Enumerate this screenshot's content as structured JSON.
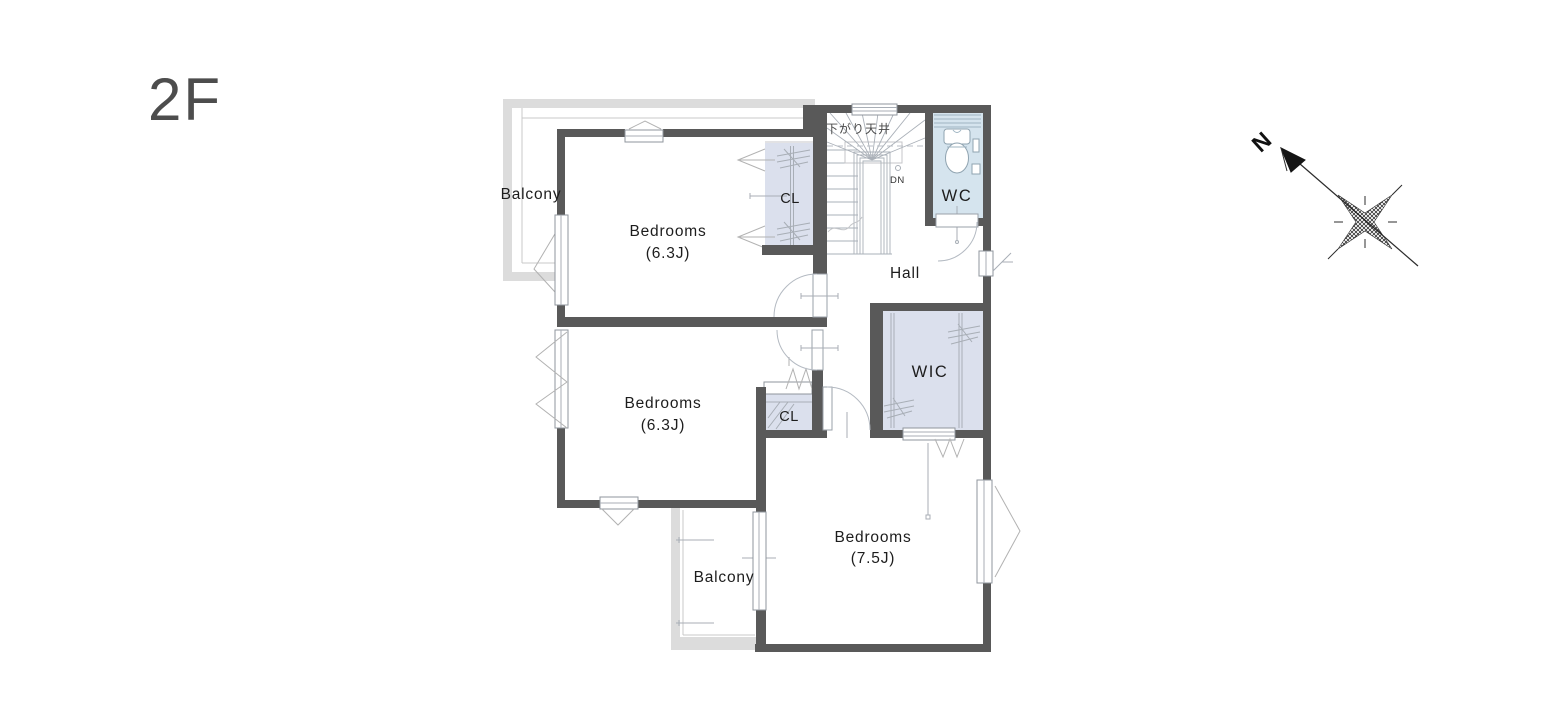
{
  "title": "2F",
  "rooms": {
    "bedroom1": {
      "label": "Bedrooms",
      "size": "(6.3J)"
    },
    "bedroom2": {
      "label": "Bedrooms",
      "size": "(6.3J)"
    },
    "bedroom3": {
      "label": "Bedrooms",
      "size": "(7.5J)"
    },
    "hall": {
      "label": "Hall"
    },
    "wc": {
      "label": "WC"
    },
    "wic": {
      "label": "WIC"
    },
    "closet_top": {
      "label": "CL"
    },
    "closet_bottom": {
      "label": "CL"
    },
    "balcony_top": {
      "label": "Balcony"
    },
    "balcony_bottom": {
      "label": "Balcony"
    }
  },
  "stairs": {
    "ceiling_note": "下がり天井",
    "direction_label": "DN"
  },
  "compass": {
    "north_label": "N"
  },
  "colors": {
    "wall": "#595959",
    "closet_fill": "#dbe0ed",
    "wc_fill": "#d5e4ee",
    "balcony_wall": "#dcdcdc",
    "title_text": "#4d4d4d",
    "label_text": "#1d1d1d"
  }
}
